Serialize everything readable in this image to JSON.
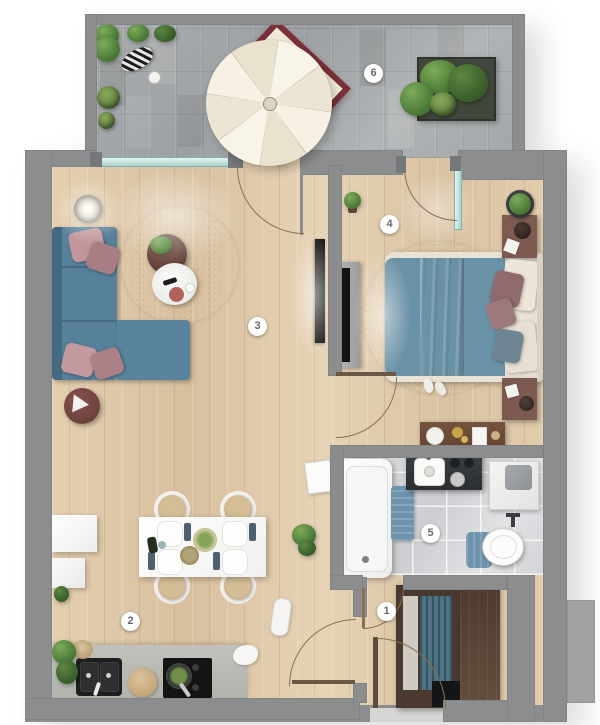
{
  "room_labels": [
    {
      "label": "1",
      "room": "entrance-hall"
    },
    {
      "label": "2",
      "room": "kitchen-dining-area"
    },
    {
      "label": "3",
      "room": "living-room"
    },
    {
      "label": "4",
      "room": "bedroom"
    },
    {
      "label": "5",
      "room": "bathroom"
    },
    {
      "label": "6",
      "room": "terrace"
    }
  ],
  "colors": {
    "wall_gray": "#8b8d8f",
    "wood_floor": "#ddc7a8",
    "terrace_paver": "#a6a9ab",
    "sofa_blue": "#57809a",
    "bed_blue": "#6a92a6",
    "accent_pink": "#c0969a",
    "rug_white": "#f1f1ef",
    "bath_tile": "#d9dadd",
    "mat_blue": "#6e93ac",
    "dark_wood": "#5a4334",
    "glass_teal": "#a9d3cc",
    "counter_gray": "#b9bab6",
    "appliance_black": "#1a1a1a",
    "umbrella_ivory": "#f5f0e2",
    "outdoor_table_red": "#7a3038"
  }
}
